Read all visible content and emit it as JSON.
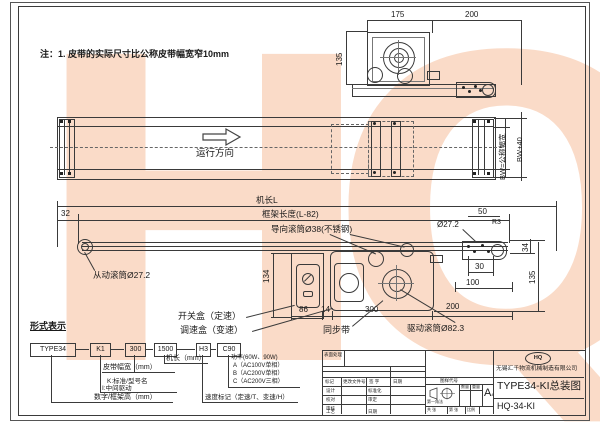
{
  "note": "注：1. 皮带的实际尺寸比公称皮带幅宽窄10mm",
  "watermark": "HQ",
  "detail_view": {
    "dim_left": "175",
    "dim_right": "200",
    "dim_height": "135"
  },
  "plan_view": {
    "direction": "运行方向",
    "dim_bw": "BW=公称幅宽",
    "dim_bw40": "BW+40"
  },
  "side_view": {
    "dim_machine_length": "机长L",
    "dim_frame_length": "框架长度(L-82)",
    "dim_32": "32",
    "dim_50": "50",
    "dim_30": "30",
    "dim_100": "100",
    "dim_34": "34",
    "dim_135": "135",
    "dim_134": "134",
    "dim_86": "86",
    "dim_14": "14",
    "dim_300": "300",
    "dim_200": "200",
    "dim_end_roller": "Ø27.2",
    "dim_r3": "R3",
    "label_guide_roller": "导向滚筒Ø38(不锈钢)",
    "label_driven_roller": "从动滚筒Ø27.2",
    "label_switch_box": "开关盒（定速）",
    "label_speed_box": "调速盒（变速）",
    "label_timing_belt": "同步带",
    "label_drive_roller": "驱动滚筒Ø82.3"
  },
  "type_code": {
    "heading": "形式表示",
    "boxes": [
      "TYPE34",
      "K1",
      "300",
      "1500",
      "H3",
      "C90"
    ],
    "machine_length": "机长（mm）",
    "belt_width": "皮带幅宽（mm）",
    "k_label": "K:标准/型号名",
    "i_label": "I:中间驱动",
    "frame_height": "数字/框架高（mm）",
    "speed_mark": "速度标记（定速/T、变速/H）",
    "power": "功率(60W、90W)",
    "power_options": [
      "A（AC100V单相）",
      "B（AC200V单相）",
      "C（AC200V三相）"
    ]
  },
  "title_block": {
    "surface": "表面处理",
    "change_header": [
      "标记",
      "更改文件号",
      "签 字",
      "日期"
    ],
    "roles_left": [
      "设计",
      "校对",
      "审核",
      "工艺"
    ],
    "roles_right": [
      "标准化",
      "审定",
      "",
      "日期"
    ],
    "drawing_code_header": "图样代号",
    "projection": "第一角法",
    "qty": "数量",
    "weight": "重量",
    "sheet_size": "A",
    "sheet_size_sub": "4",
    "sheet_cells": [
      "共 张",
      "第 张",
      "比例"
    ],
    "logo": "HQ",
    "company": "无锡汇千物流机械制造有限公司",
    "title": "TYPE34-KI总装图",
    "code": "HQ-34-KI"
  }
}
